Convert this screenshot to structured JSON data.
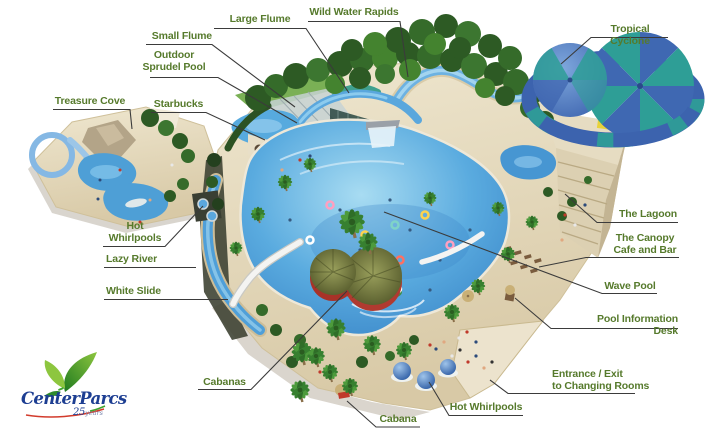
{
  "page": {
    "background": "#ffffff",
    "description": "Illustrated aerial map of a subtropical swimming paradise water park with labelled attractions"
  },
  "labels": {
    "small_flume": "Small Flume",
    "outdoor_sprudel_pool": "Outdoor\nSprudel Pool",
    "large_flume": "Large Flume",
    "wild_water_rapids": "Wild Water Rapids",
    "tropical_cyclone": "Tropical Cyclone",
    "treasure_cove": "Treasure Cove",
    "starbucks": "Starbucks",
    "hot_whirlpools_left": "Hot\nWhirlpools",
    "lazy_river": "Lazy River",
    "white_slide": "White Slide",
    "cabanas": "Cabanas",
    "cabana": "Cabana",
    "hot_whirlpools_right": "Hot Whirlpools",
    "the_lagoon": "The Lagoon",
    "canopy_cafe_bar": "The Canopy\nCafe and Bar",
    "wave_pool": "Wave Pool",
    "pool_information_desk": "Pool Information Desk",
    "entrance_exit": "Entrance / Exit\nto Changing Rooms"
  },
  "logo": {
    "brand": "CenterParcs",
    "anniversary_number": "25",
    "anniversary_word": "years"
  },
  "colors": {
    "label_text": "#567a2c",
    "leader_line": "#3b3b3b",
    "pool_water": "#4e9fd6",
    "sand": "#e2d6b8",
    "canopy_green": "#2f6426",
    "cyclone_blue": "#3c63ae",
    "cyclone_teal": "#2e9e96",
    "logo_blue": "#1d3e92",
    "logo_green": "#3fa32e",
    "logo_red": "#d23b2c"
  }
}
